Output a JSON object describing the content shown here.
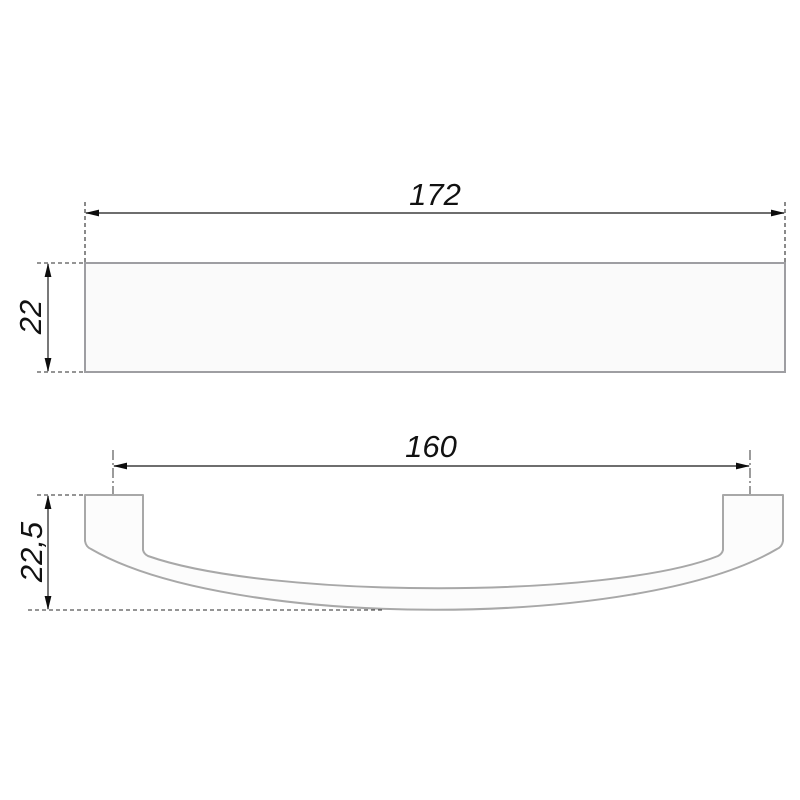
{
  "page": {
    "background": "#ffffff",
    "kind": "technical-drawing",
    "subject": "cabinet-bow-handle"
  },
  "drawing": {
    "colors": {
      "dimension_line": "#3f3f3f",
      "arrow": "#0d0d0d",
      "extension_line": "#2b2b2b",
      "center_line": "#4a4a4a",
      "object_outline": "#9e9ea2",
      "handle_outline": "#a8a8a8",
      "object_fill": "#fafafa",
      "handle_fill": "#fcfcfc",
      "text": "#111111"
    },
    "views": {
      "top_view": {
        "length_label": "172",
        "height_label": "22"
      },
      "front_view": {
        "hole_spacing_label": "160",
        "height_label": "22,5"
      }
    }
  }
}
